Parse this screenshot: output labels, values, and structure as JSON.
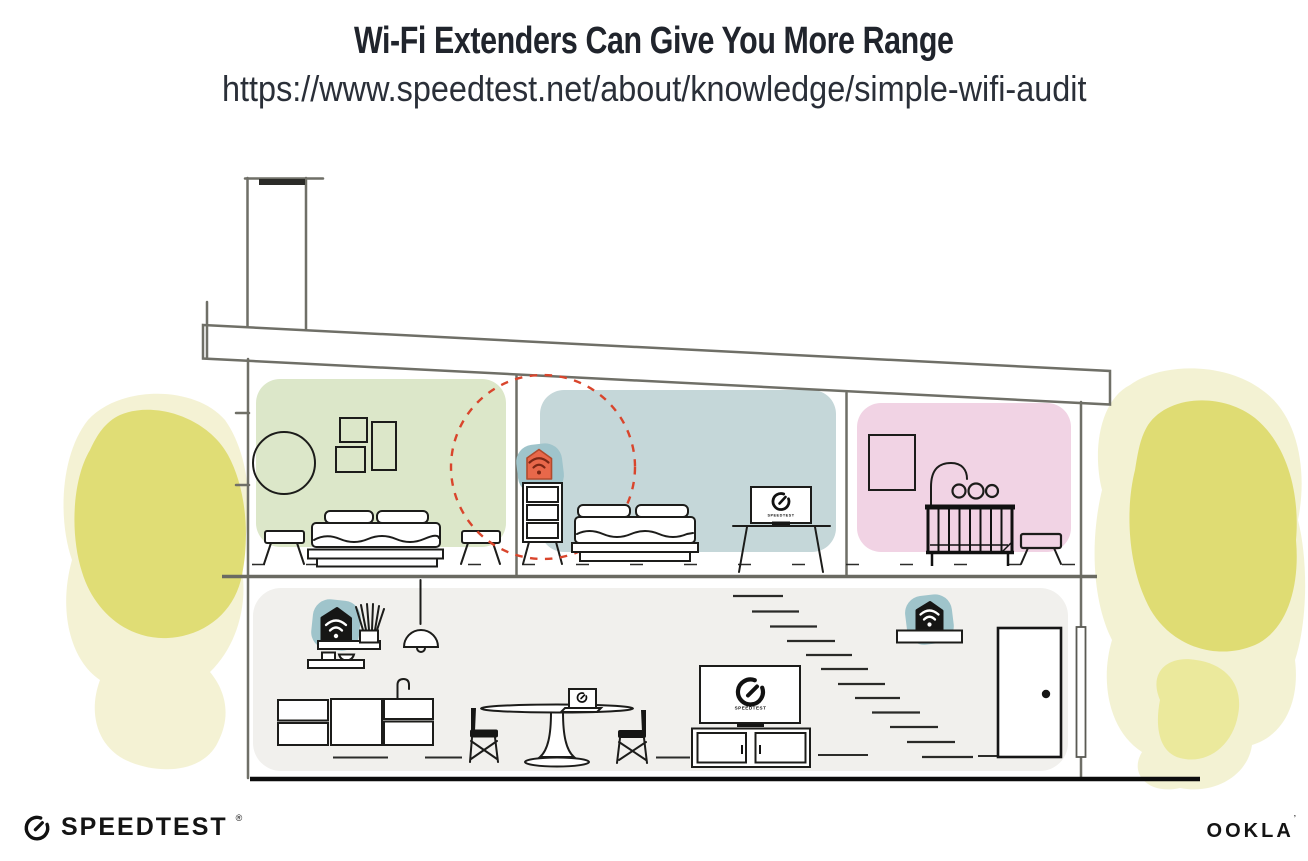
{
  "header": {
    "title": "Wi-Fi Extenders Can Give You More Range",
    "url": "https://www.speedtest.net/about/knowledge/simple-wifi-audit"
  },
  "illustration": {
    "bedroom_tv": {
      "label": "SPEEDTEST"
    },
    "living_tv": {
      "label": "SPEEDTEST"
    },
    "icons": {
      "wifi": "wifi-signal-icon",
      "gauge": "speedtest-gauge-icon"
    },
    "colors": {
      "ink": "#161615",
      "structure": "#6f6f67",
      "room_green": "#dce7c9",
      "room_blue": "#c5d7d9",
      "room_pink": "#f1d3e4",
      "floor_gray": "#f1f0ed",
      "teal": "#9fc4cb",
      "orange": "#e8684a",
      "wifi_dark": "#7b2715",
      "coverage_red": "#d9452c",
      "yellow": "#ddd968",
      "yellow_mid": "#e9e68e",
      "yellow_light": "#f0eec6"
    }
  },
  "footer": {
    "speedtest": {
      "label": "SPEEDTEST",
      "mark": "®"
    },
    "ookla": {
      "label": "OOKLA",
      "mark": "’"
    }
  }
}
